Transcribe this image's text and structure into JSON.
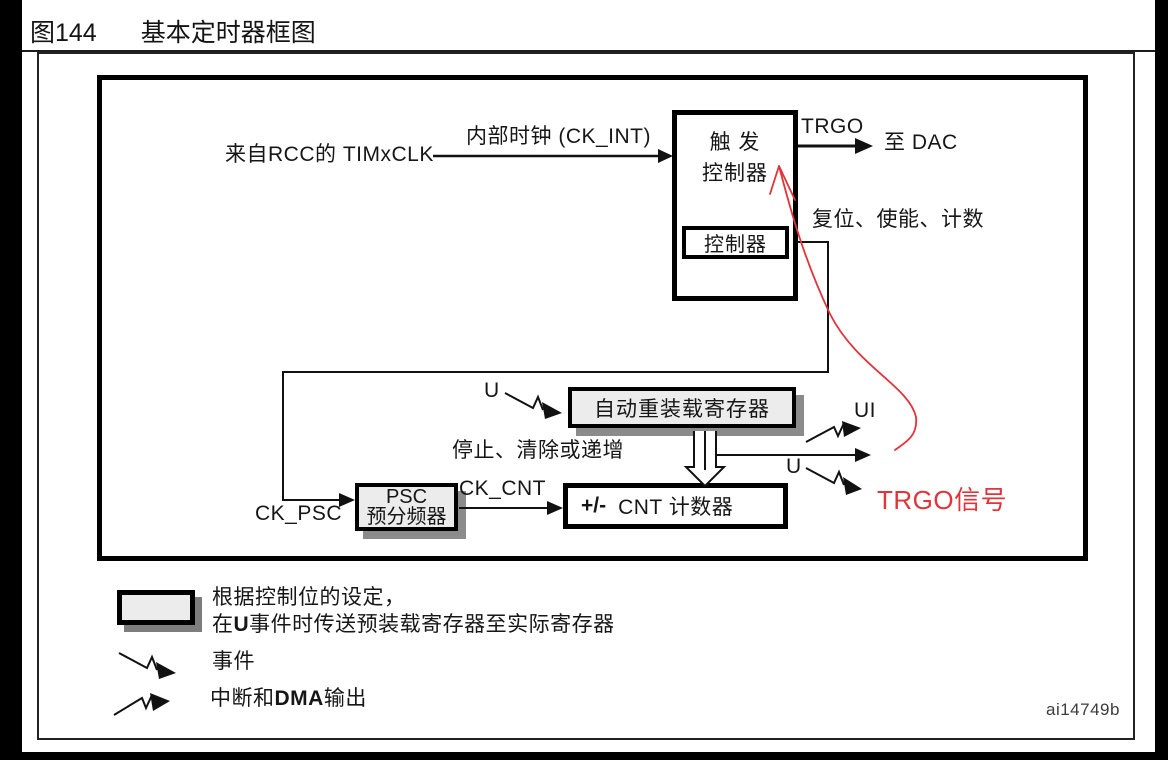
{
  "page": {
    "title_label": "图144",
    "title_text": "基本定时器框图",
    "watermark": "ai14749b"
  },
  "colors": {
    "line": "#111111",
    "box_fill": "#ececec",
    "box_shadow": "#8b8b8b",
    "annotation_red": "#e2333a"
  },
  "icons": {
    "event": "zigzag-arrow-down-right",
    "interrupt_dma": "zigzag-arrow-up-right",
    "preload_transfer": "hollow-down-arrow",
    "annotation": "hand-drawn-red-curve-arrow"
  },
  "diagram": {
    "labels": {
      "from_rcc": "来自RCC的 TIMxCLK",
      "internal_clock": "内部时钟 (CK_INT)",
      "trgo": "TRGO",
      "to_dac": "至 DAC",
      "reset_enable_count": "复位、使能、计数",
      "stop_clear_increment": "停止、清除或递增",
      "u_arr": "U",
      "ui": "UI",
      "u_out": "U",
      "ck_psc": "CK_PSC",
      "ck_cnt": "CK_CNT",
      "trgo_signal": "TRGO信号"
    },
    "blocks": {
      "trigger_line1": "触 发",
      "trigger_line2": "控制器",
      "controller": "控制器",
      "auto_reload": "自动重装载寄存器",
      "psc_line1": "PSC",
      "psc_line2": "预分频器",
      "counter_sign": "+/-",
      "counter_label": "CNT 计数器"
    },
    "legend": {
      "note_line1": "根据控制位的设定，",
      "note2_pre": "在",
      "note2_bold": "U",
      "note2_post": "事件时传送预装载寄存器至实际寄存器",
      "event": "事件",
      "irq_pre": "中断和",
      "irq_bold": "DMA",
      "irq_post": "输出"
    }
  }
}
